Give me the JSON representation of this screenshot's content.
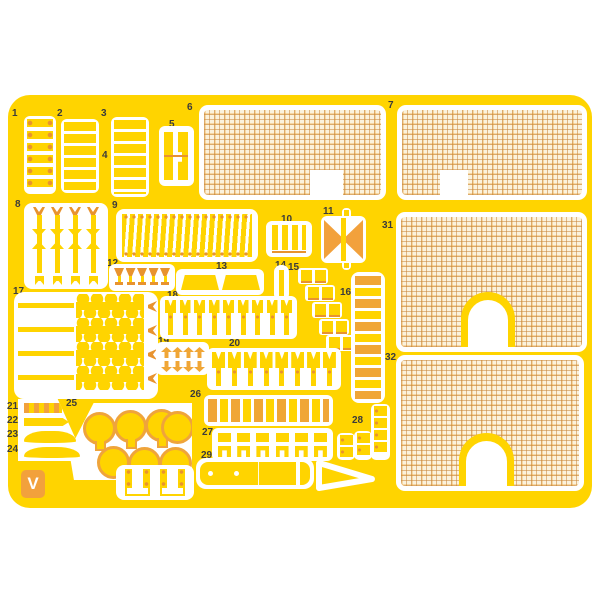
{
  "diagram": {
    "kind": "model kit photo-etch fret sheet",
    "brand_letter": "V",
    "sheet_color": "#FFD400",
    "accent_color": "#F0A636",
    "mesh_line_color": "#C8873C"
  },
  "labels": [
    {
      "text": "1"
    },
    {
      "text": "2"
    },
    {
      "text": "3"
    },
    {
      "text": "4"
    },
    {
      "text": "5"
    },
    {
      "text": "6"
    },
    {
      "text": "7"
    },
    {
      "text": "8"
    },
    {
      "text": "9"
    },
    {
      "text": "10"
    },
    {
      "text": "11"
    },
    {
      "text": "12"
    },
    {
      "text": "13"
    },
    {
      "text": "14"
    },
    {
      "text": "15"
    },
    {
      "text": "16"
    },
    {
      "text": "17"
    },
    {
      "text": "18"
    },
    {
      "text": "19"
    },
    {
      "text": "20"
    },
    {
      "text": "21"
    },
    {
      "text": "22"
    },
    {
      "text": "23"
    },
    {
      "text": "24"
    },
    {
      "text": "25"
    },
    {
      "text": "26"
    },
    {
      "text": "27"
    },
    {
      "text": "28"
    },
    {
      "text": "29"
    },
    {
      "text": "30"
    },
    {
      "text": "31"
    },
    {
      "text": "32"
    },
    {
      "text": "33"
    }
  ]
}
